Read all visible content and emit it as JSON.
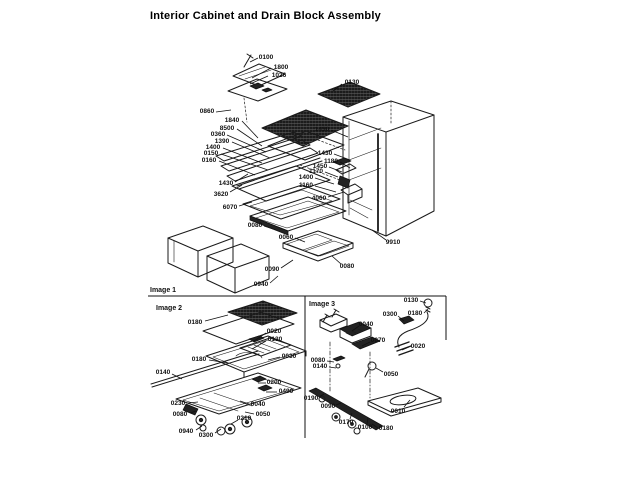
{
  "title": "Interior Cabinet and Drain Block Assembly",
  "figure": {
    "sections": [
      {
        "id": "image1",
        "label": "Image 1"
      },
      {
        "id": "image2",
        "label": "Image 2"
      },
      {
        "id": "image3",
        "label": "Image 3"
      }
    ],
    "callouts": {
      "image1": [
        {
          "text": "0100",
          "tx": 266,
          "ty": 57,
          "line": [
            258,
            58,
            250,
            62
          ]
        },
        {
          "text": "1800",
          "tx": 281,
          "ty": 67,
          "line": [
            271,
            68,
            252,
            78
          ]
        },
        {
          "text": "1026",
          "tx": 279,
          "ty": 75,
          "line": [
            268,
            76,
            250,
            84
          ]
        },
        {
          "text": "0130",
          "tx": 352,
          "ty": 82,
          "line": [
            342,
            84,
            333,
            91
          ]
        },
        {
          "text": "0860",
          "tx": 207,
          "ty": 111,
          "line": [
            216,
            112,
            231,
            110
          ]
        },
        {
          "text": "1840",
          "tx": 232,
          "ty": 120,
          "line": [
            242,
            121,
            258,
            138
          ]
        },
        {
          "text": "8500",
          "tx": 227,
          "ty": 128,
          "line": [
            237,
            129,
            262,
            146
          ]
        },
        {
          "text": "0360",
          "tx": 218,
          "ty": 134,
          "line": [
            227,
            135,
            266,
            152
          ]
        },
        {
          "text": "1390",
          "tx": 222,
          "ty": 141,
          "line": [
            232,
            142,
            270,
            158
          ]
        },
        {
          "text": "1400",
          "tx": 213,
          "ty": 147,
          "line": [
            223,
            148,
            262,
            163
          ]
        },
        {
          "text": "0150",
          "tx": 211,
          "ty": 153,
          "line": [
            221,
            154,
            268,
            170
          ]
        },
        {
          "text": "0160",
          "tx": 209,
          "ty": 160,
          "line": [
            219,
            161,
            255,
            175
          ]
        },
        {
          "text": "1430",
          "tx": 226,
          "ty": 183,
          "line": [
            235,
            182,
            248,
            174
          ]
        },
        {
          "text": "3620",
          "tx": 221,
          "ty": 194,
          "line": [
            230,
            192,
            242,
            185
          ]
        },
        {
          "text": "6070",
          "tx": 230,
          "ty": 207,
          "line": [
            239,
            206,
            252,
            202
          ]
        },
        {
          "text": "1430",
          "tx": 322,
          "ty": 129,
          "line": [
            331,
            130,
            348,
            137
          ]
        },
        {
          "text": "1430",
          "tx": 325,
          "ty": 153,
          "line": [
            334,
            154,
            350,
            160
          ]
        },
        {
          "text": "1180",
          "tx": 331,
          "ty": 161,
          "line": [
            340,
            162,
            350,
            168
          ]
        },
        {
          "text": "1450",
          "tx": 320,
          "ty": 166,
          "line": [
            329,
            167,
            342,
            172
          ]
        },
        {
          "text": "1170",
          "tx": 316,
          "ty": 171,
          "line": [
            325,
            172,
            338,
            177
          ]
        },
        {
          "text": "1400",
          "tx": 306,
          "ty": 177,
          "line": [
            315,
            178,
            334,
            184
          ]
        },
        {
          "text": "1160",
          "tx": 306,
          "ty": 185,
          "line": [
            315,
            186,
            336,
            192
          ]
        },
        {
          "text": "4060",
          "tx": 319,
          "ty": 198,
          "line": [
            328,
            197,
            344,
            192
          ]
        },
        {
          "text": "0080",
          "tx": 255,
          "ty": 225,
          "line": [
            264,
            226,
            276,
            230
          ]
        },
        {
          "text": "0060",
          "tx": 286,
          "ty": 237,
          "line": [
            295,
            238,
            305,
            242
          ]
        },
        {
          "text": "0090",
          "tx": 272,
          "ty": 269,
          "line": [
            281,
            268,
            293,
            260
          ]
        },
        {
          "text": "0940",
          "tx": 261,
          "ty": 284,
          "line": [
            270,
            283,
            278,
            276
          ]
        },
        {
          "text": "0080",
          "tx": 347,
          "ty": 266,
          "line": [
            341,
            264,
            332,
            256
          ]
        },
        {
          "text": "9910",
          "tx": 393,
          "ty": 242,
          "line": [
            386,
            240,
            372,
            230
          ]
        }
      ],
      "image2": [
        {
          "text": "0180",
          "tx": 195,
          "ty": 322,
          "line": [
            205,
            321,
            228,
            315
          ]
        },
        {
          "text": "0020",
          "tx": 274,
          "ty": 331,
          "line": [
            266,
            333,
            254,
            341
          ]
        },
        {
          "text": "0130",
          "tx": 275,
          "ty": 339,
          "line": [
            266,
            341,
            252,
            349
          ]
        },
        {
          "text": "0030",
          "tx": 289,
          "ty": 356,
          "line": [
            280,
            357,
            268,
            360
          ]
        },
        {
          "text": "0180",
          "tx": 199,
          "ty": 359,
          "line": [
            209,
            360,
            228,
            363
          ]
        },
        {
          "text": "0140",
          "tx": 163,
          "ty": 372,
          "line": [
            172,
            374,
            182,
            379
          ]
        },
        {
          "text": "0200",
          "tx": 274,
          "ty": 382,
          "line": [
            266,
            383,
            258,
            383
          ]
        },
        {
          "text": "0490",
          "tx": 286,
          "ty": 391,
          "line": [
            277,
            392,
            266,
            392
          ]
        },
        {
          "text": "0230",
          "tx": 178,
          "ty": 403,
          "line": [
            188,
            403,
            198,
            402
          ]
        },
        {
          "text": "0040",
          "tx": 258,
          "ty": 404,
          "line": [
            249,
            404,
            240,
            401
          ]
        },
        {
          "text": "0080",
          "tx": 180,
          "ty": 414,
          "line": [
            190,
            413,
            196,
            411
          ]
        },
        {
          "text": "0050",
          "tx": 263,
          "ty": 414,
          "line": [
            254,
            414,
            245,
            412
          ]
        },
        {
          "text": "0210",
          "tx": 244,
          "ty": 418,
          "line": [
            238,
            420,
            231,
            424
          ]
        },
        {
          "text": "0940",
          "tx": 186,
          "ty": 431,
          "line": [
            196,
            430,
            202,
            426
          ]
        },
        {
          "text": "0300",
          "tx": 206,
          "ty": 435,
          "line": [
            215,
            433,
            221,
            429
          ]
        }
      ],
      "image3": [
        {
          "text": "0130",
          "tx": 411,
          "ty": 300,
          "line": [
            420,
            301,
            426,
            303
          ]
        },
        {
          "text": "0180",
          "tx": 415,
          "ty": 313,
          "line": [
            424,
            313,
            428,
            309
          ]
        },
        {
          "text": "0300",
          "tx": 390,
          "ty": 314,
          "line": [
            398,
            316,
            404,
            321
          ]
        },
        {
          "text": "0040",
          "tx": 366,
          "ty": 324,
          "line": [
            359,
            326,
            352,
            331
          ]
        },
        {
          "text": "0070",
          "tx": 378,
          "ty": 340,
          "line": [
            370,
            342,
            362,
            346
          ]
        },
        {
          "text": "0020",
          "tx": 418,
          "ty": 346,
          "line": [
            409,
            347,
            402,
            350
          ]
        },
        {
          "text": "0080",
          "tx": 318,
          "ty": 360,
          "line": [
            327,
            361,
            334,
            362
          ]
        },
        {
          "text": "0140",
          "tx": 320,
          "ty": 366,
          "line": [
            329,
            367,
            336,
            368
          ]
        },
        {
          "text": "0050",
          "tx": 391,
          "ty": 374,
          "line": [
            383,
            372,
            376,
            368
          ]
        },
        {
          "text": "0190",
          "tx": 311,
          "ty": 398,
          "line": [
            319,
            397,
            324,
            394
          ]
        },
        {
          "text": "0090",
          "tx": 328,
          "ty": 406,
          "line": [
            336,
            405,
            341,
            403
          ]
        },
        {
          "text": "0170",
          "tx": 346,
          "ty": 422,
          "line": [
            350,
            419,
            352,
            413
          ]
        },
        {
          "text": "0100",
          "tx": 365,
          "ty": 427,
          "line": [
            367,
            424,
            368,
            418
          ]
        },
        {
          "text": "0180",
          "tx": 386,
          "ty": 428,
          "line": [
            378,
            428,
            372,
            424
          ]
        },
        {
          "text": "0010",
          "tx": 398,
          "ty": 411,
          "line": [
            404,
            407,
            410,
            400
          ]
        }
      ]
    }
  }
}
